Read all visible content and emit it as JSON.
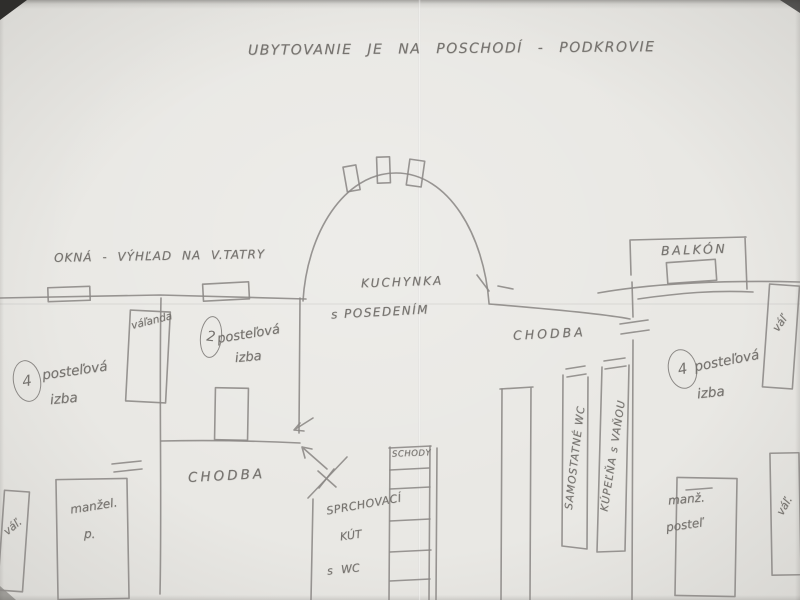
{
  "colors": {
    "paper": "#e9e8e4",
    "pencil": "#8b8885",
    "handwriting": "#76736f"
  },
  "title": "UBYTOVANIE JE NA POSCHODÍ - PODKROVIE",
  "notes": {
    "windows_view": "OKNÁ - VÝHĽAD NA V.TATRY"
  },
  "rooms": {
    "left_bedroom": {
      "number": "4",
      "name_line1": "posteľová",
      "name_line2": "izba"
    },
    "small_bedroom": {
      "number": "2",
      "name_line1": "posteľová",
      "name_line2": "izba"
    },
    "right_bedroom": {
      "number": "4",
      "name_line1": "posteľová",
      "name_line2": "izba"
    },
    "hall_left": "CHODBA",
    "hall_right": "CHODBA",
    "kitchen_line1": "KUCHYNKA",
    "kitchen_line2": "s POSEDENÍM",
    "shower_line1": "SPRCHOVACÍ",
    "shower_line2": "KÚT",
    "shower_line3": "s WC",
    "stairs": "SCHODY",
    "wc_strip": "SAMOSTATNÉ WC",
    "bath_strip": "KÚPEĽŇA s VAŇOU",
    "balcony": "BALKÓN"
  },
  "furniture": {
    "left_daybed": "váľanda",
    "left_bottom_daybed": "váľ.",
    "left_double_bed_line1": "manžel.",
    "left_double_bed_line2": "p.",
    "right_top_daybed": "váľ",
    "right_bottom_daybed": "váľ.",
    "right_double_bed_line1": "manž.",
    "right_double_bed_line2": "posteľ"
  }
}
